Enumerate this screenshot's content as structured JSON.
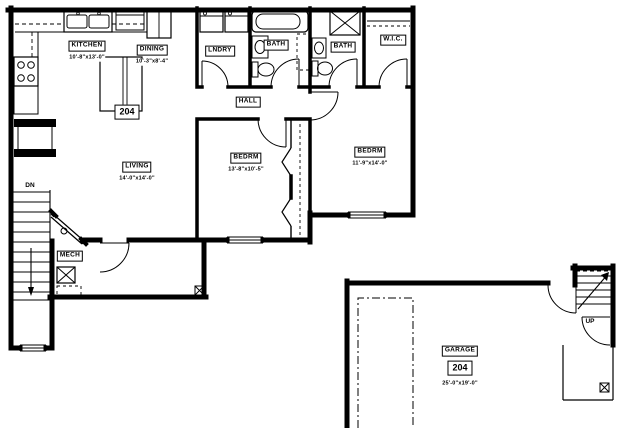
{
  "plan": {
    "unit": {
      "number": "204"
    },
    "rooms": {
      "kitchen": {
        "label": "KITCHEN",
        "dims": "10'-8\"x13'-0\""
      },
      "dining": {
        "label": "DINING",
        "dims": "10'-3\"x8'-4\""
      },
      "living": {
        "label": "LIVING",
        "dims": "14'-0\"x14'-0\""
      },
      "laundry": {
        "label": "LNDRY"
      },
      "bath_main": {
        "label": "BATH"
      },
      "bath_hall": {
        "label": "BATH"
      },
      "hall": {
        "label": "HALL"
      },
      "wic": {
        "label": "W.I.C."
      },
      "bedroom_left": {
        "label": "BEDRM",
        "dims": "13'-8\"x10'-5\""
      },
      "bedroom_right": {
        "label": "BEDRM",
        "dims": "11'-9\"x14'-0\""
      },
      "mech": {
        "label": "MECH"
      },
      "garage": {
        "label": "GARAGE",
        "unit_number": "204",
        "dims": "25'-0\"x19'-0\""
      }
    },
    "stairs": {
      "down": "DN",
      "up": "UP"
    },
    "colors": {
      "line": "#000000",
      "background": "#ffffff"
    }
  }
}
